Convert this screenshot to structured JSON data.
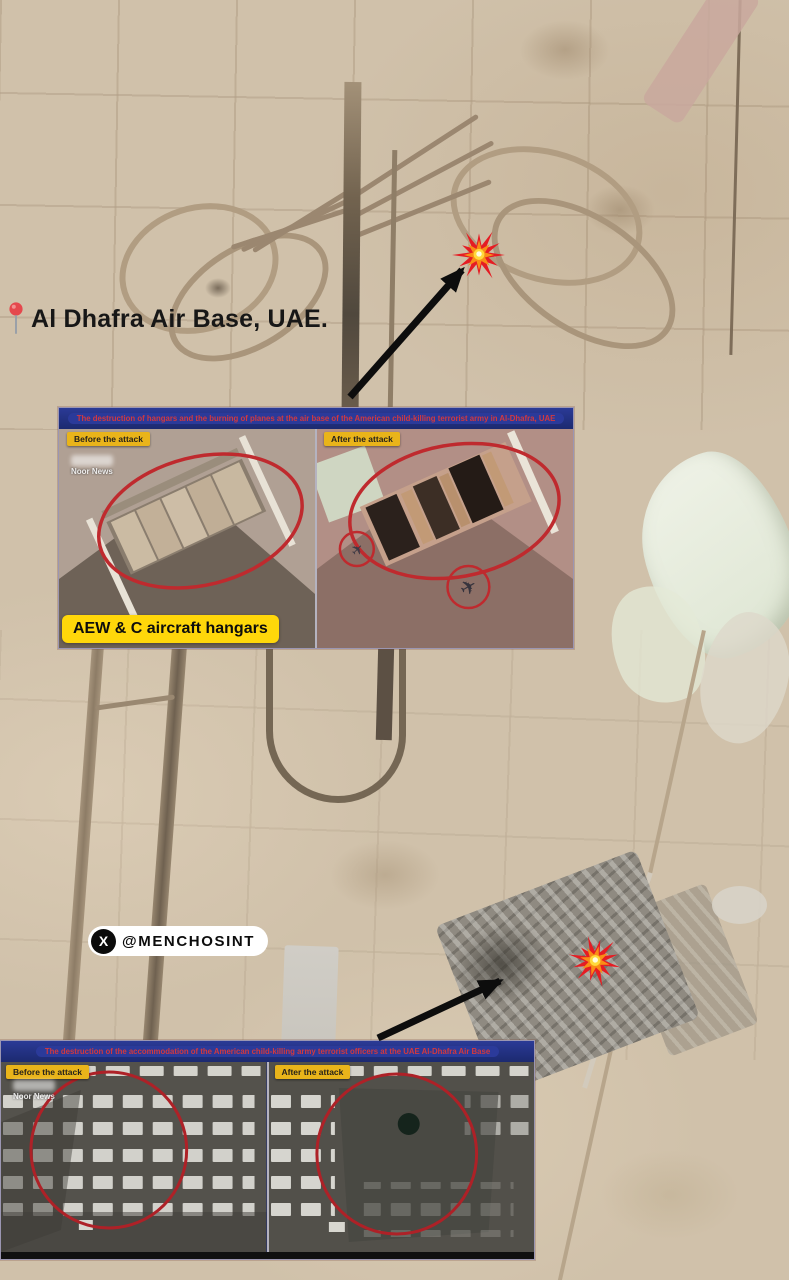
{
  "page": {
    "title": "Al Dhafra Air Base, UAE.",
    "watermark_handle": "@MENCHOSINT"
  },
  "icons": {
    "x_logo_glyph": "X",
    "plane_glyph": "✈"
  },
  "panels": [
    {
      "header": "The destruction of hangars and the burning of planes at the air base of the American child-killing terrorist army in Al-Dhafra, UAE",
      "before_label": "Before the attack",
      "after_label": "After the attack",
      "source_watermark": "Noor News",
      "caption": "AEW & C aircraft hangars"
    },
    {
      "header": "The destruction of the accommodation of the American child-killing army terrorist officers at the UAE Al-Dhafra Air Base",
      "before_label": "Before the attack",
      "after_label": "After the attack",
      "source_watermark": "Noor News"
    }
  ],
  "colors": {
    "banner_bg": "#1c2a78",
    "banner_text": "#d2393f",
    "attack_tag_bg": "#e9b41a",
    "caption_bg": "#ffd70a",
    "annotation_red": "#bf2a2e",
    "arrow": "#0d0d0d",
    "sand_base": "#d0c1aa"
  }
}
